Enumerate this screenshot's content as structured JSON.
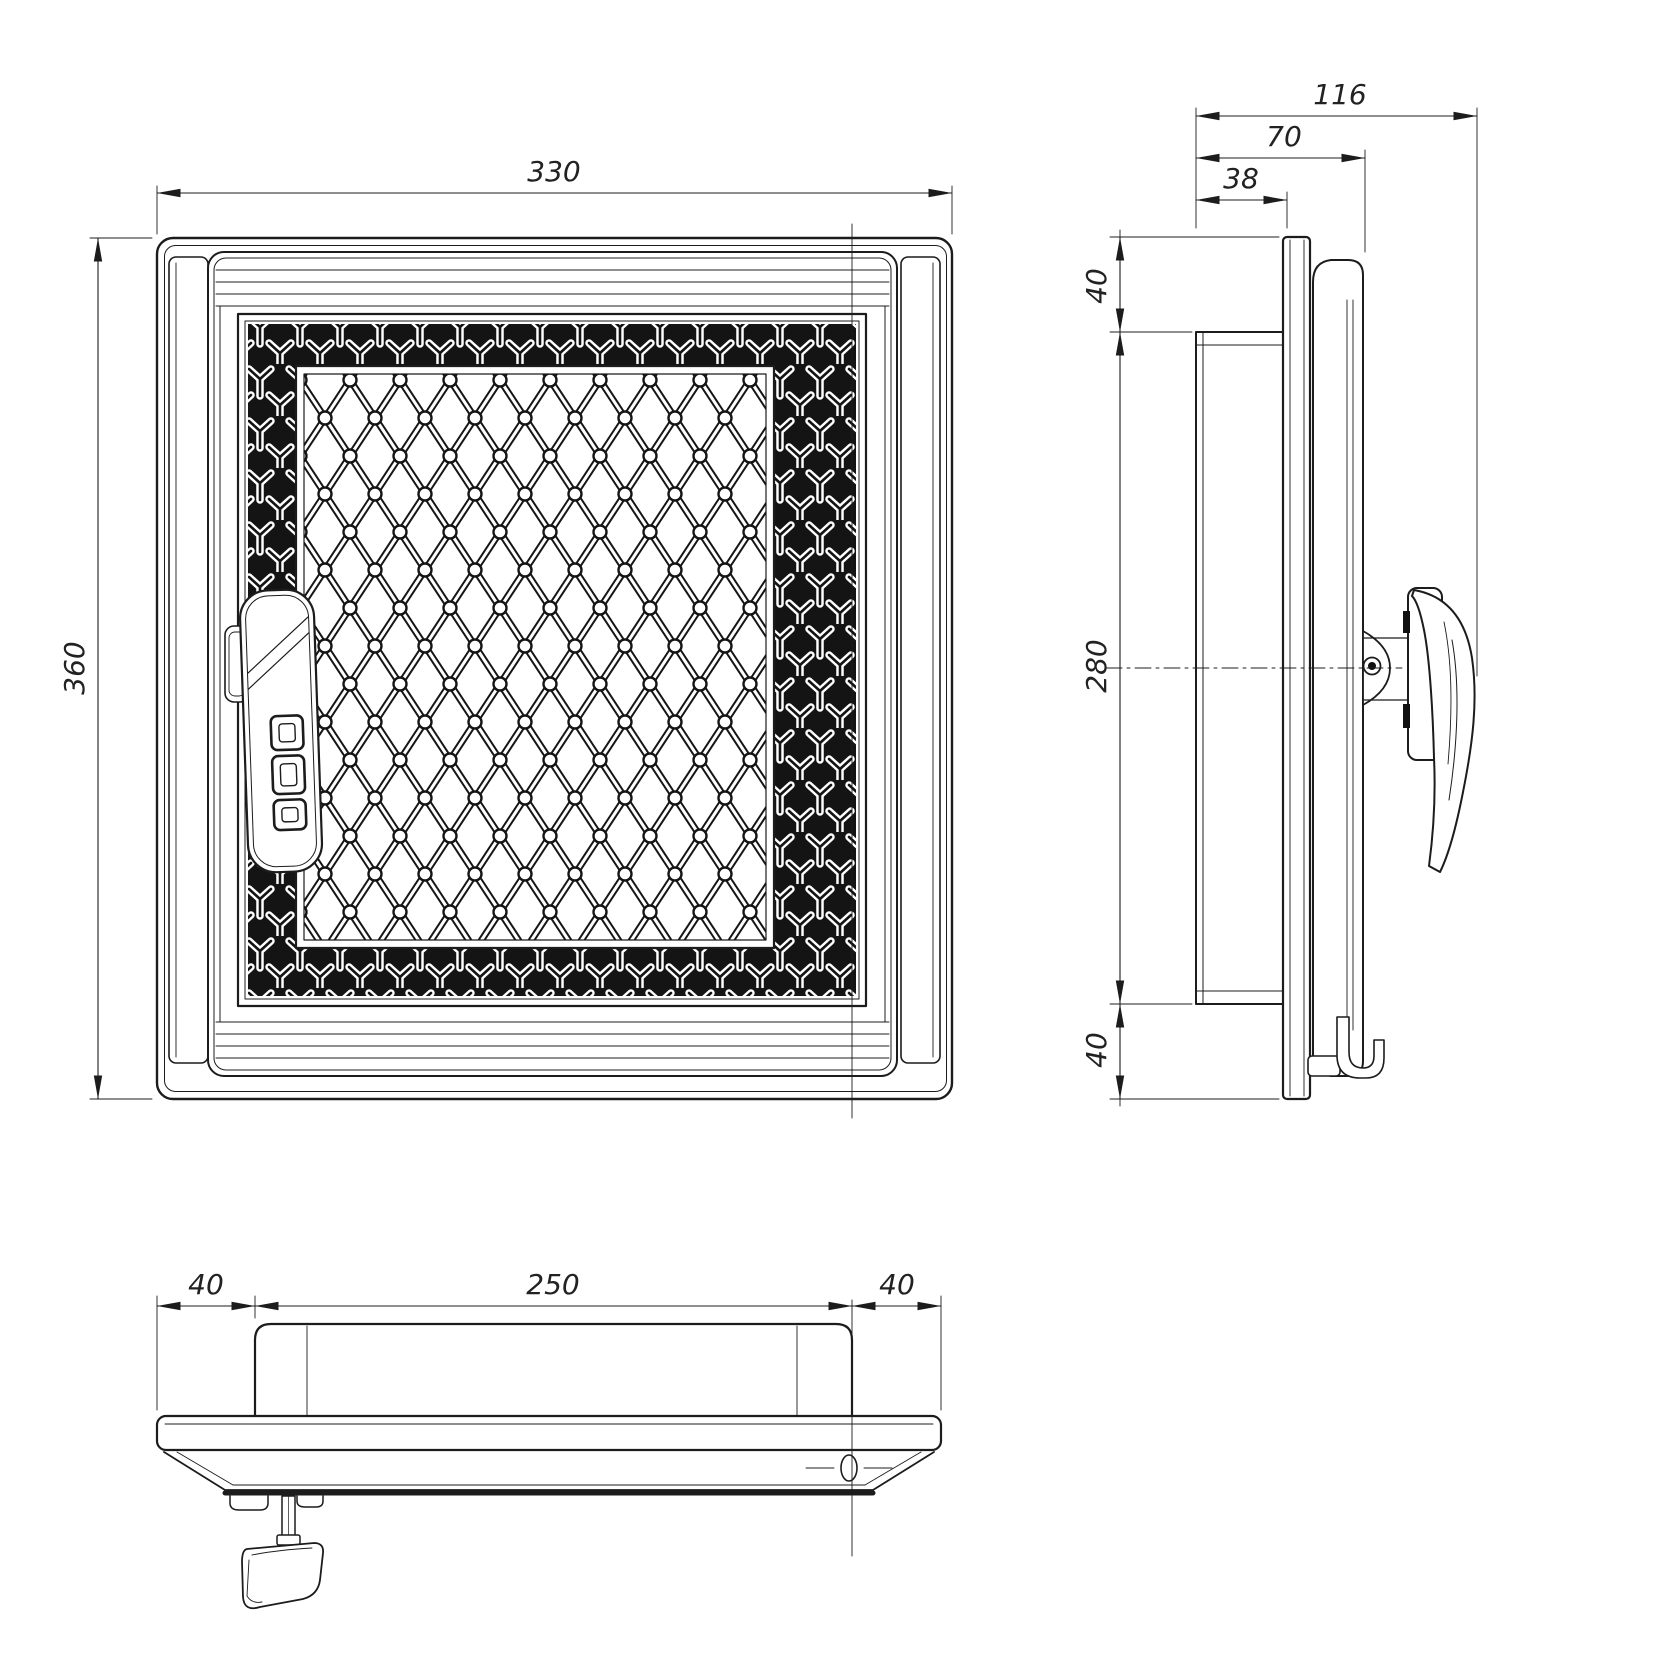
{
  "page": {
    "background": "#ffffff",
    "ink": "#1c1c1c",
    "drawing_type": "technical-drawing, fireplace revision door, three orthographic views"
  },
  "front_view": {
    "width": "330",
    "height": "360"
  },
  "side_view": {
    "total_depth": "116",
    "door_depth": "70",
    "frame_depth": "38",
    "top_offset": "40",
    "opening_height": "280",
    "bottom_offset": "40"
  },
  "bottom_view": {
    "left_offset": "40",
    "opening_width": "250",
    "right_offset": "40"
  }
}
